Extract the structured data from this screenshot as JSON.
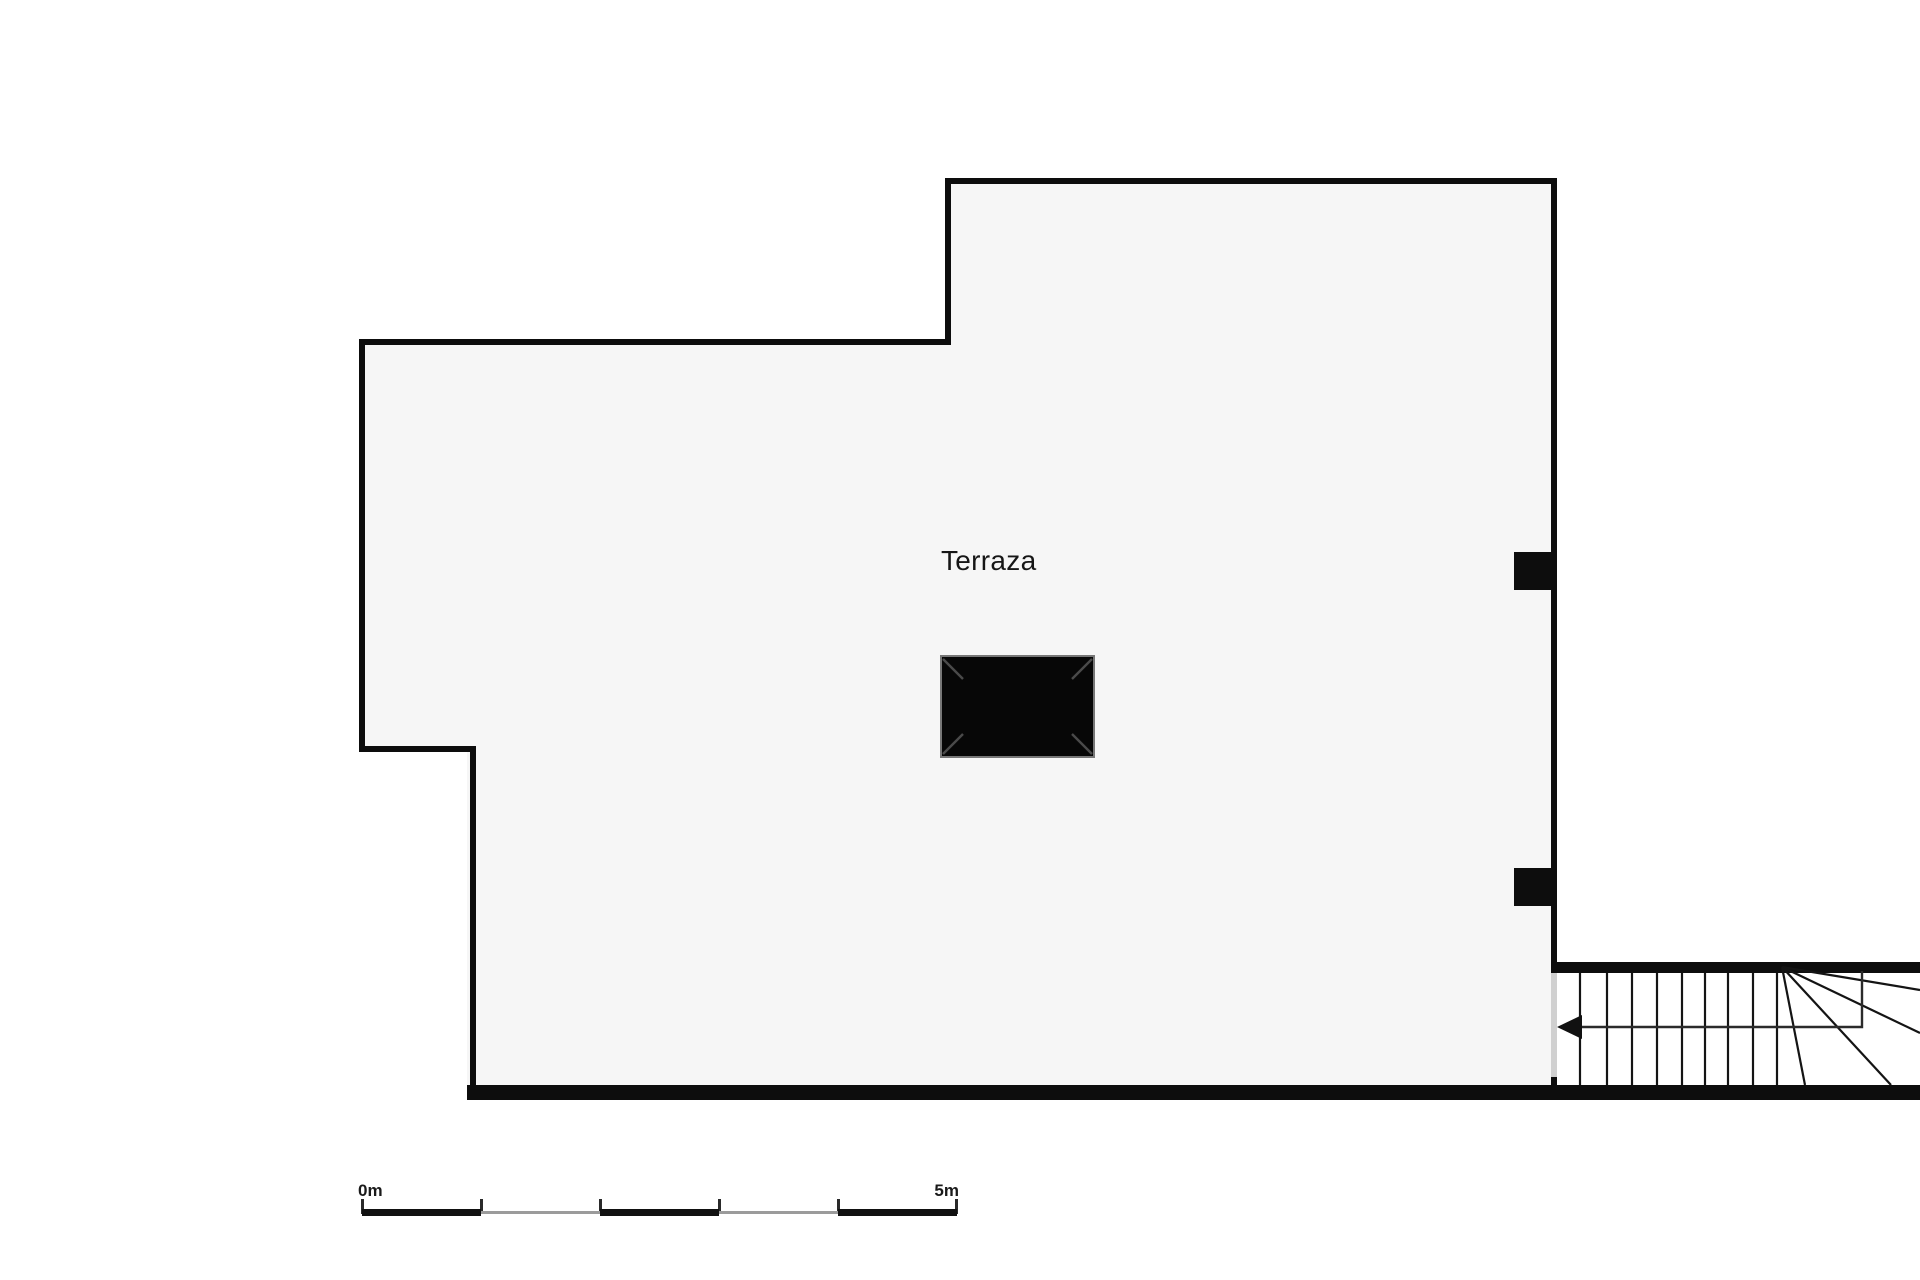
{
  "floorplan": {
    "room_label": "Terraza",
    "colors": {
      "background": "#ffffff",
      "wall": "#0d0d0d",
      "floor_fill": "#f6f6f6",
      "door_opening": "#d0d0d0",
      "chimney_fill": "#070707",
      "chimney_outline": "#777777",
      "stair_line": "#141414",
      "label_text": "#161616"
    },
    "icons": {
      "stair_direction_arrow": "◀"
    }
  },
  "scale_bar": {
    "start_label": "0m",
    "end_label": "5m",
    "segment_colors": {
      "thick": "#111111",
      "thin": "#9b9b9b"
    }
  }
}
